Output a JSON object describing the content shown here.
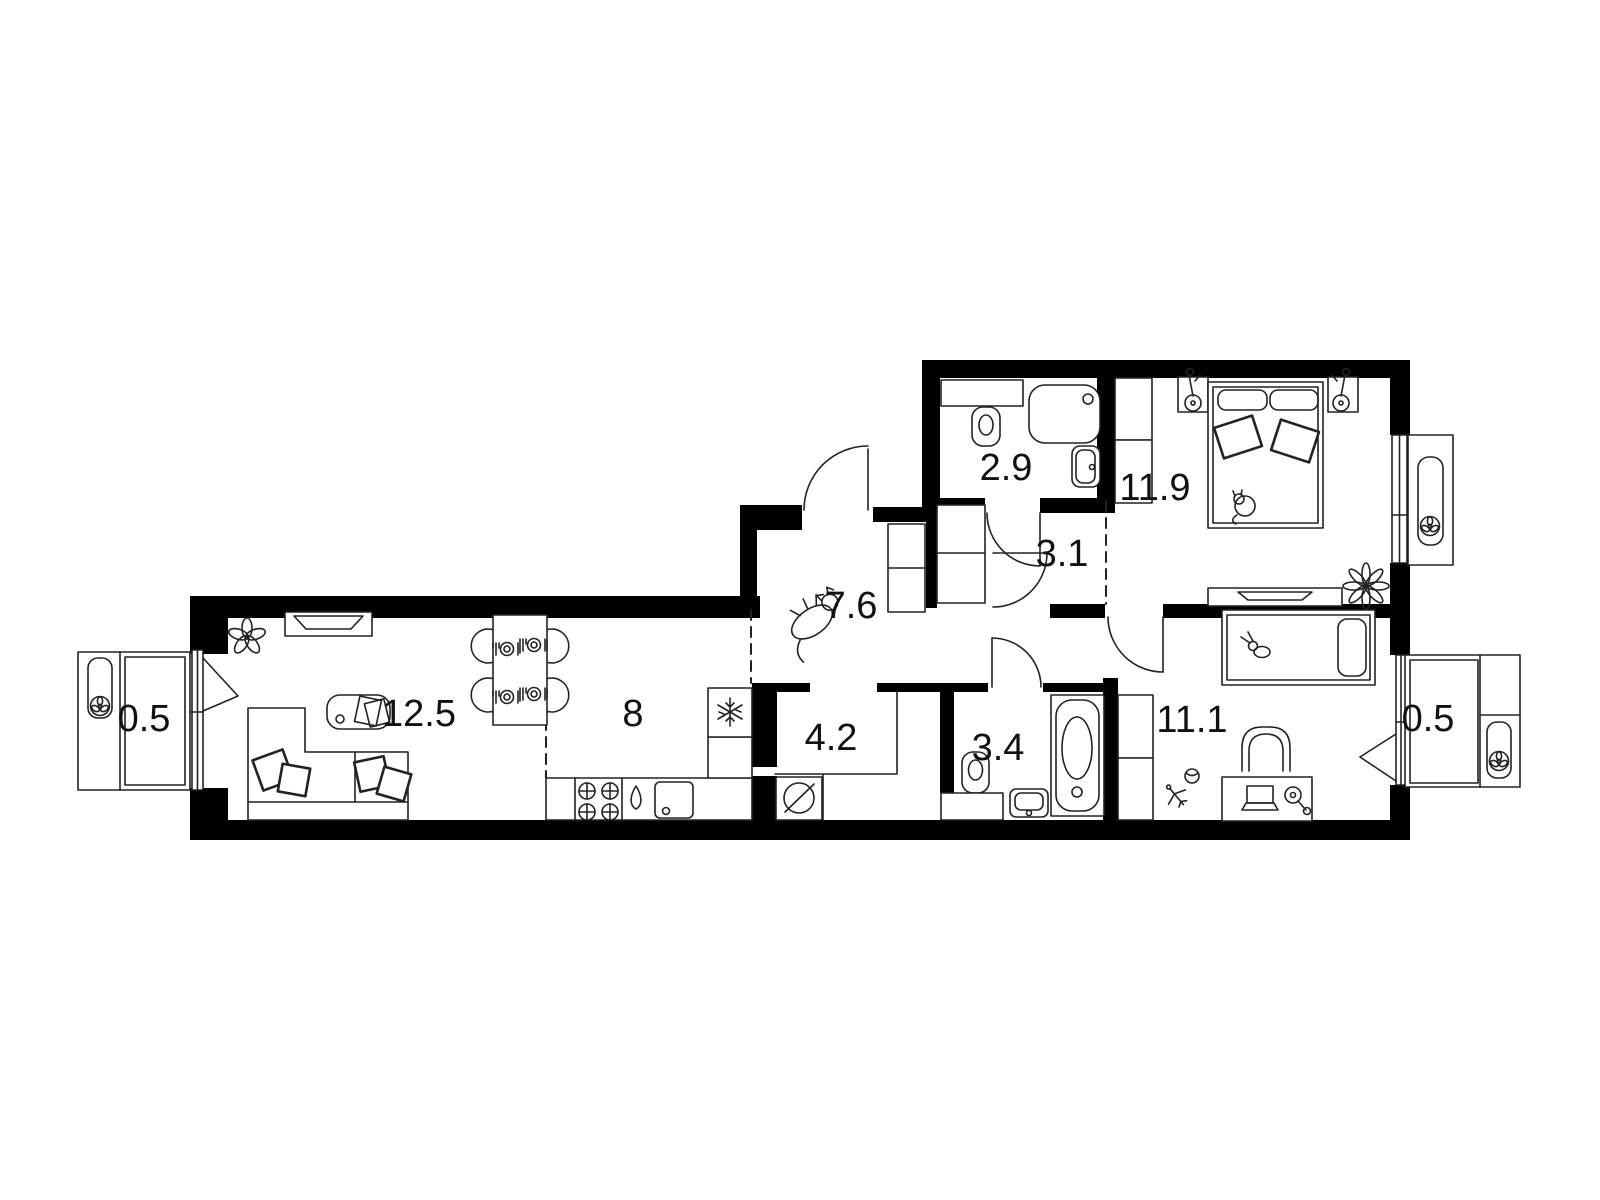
{
  "floorplan": {
    "rooms": [
      {
        "id": "balcony-left",
        "area": "0.5"
      },
      {
        "id": "living-room",
        "area": "12.5"
      },
      {
        "id": "kitchen",
        "area": "8"
      },
      {
        "id": "hallway",
        "area": "7.6"
      },
      {
        "id": "laundry",
        "area": "4.2"
      },
      {
        "id": "bathroom",
        "area": "3.4"
      },
      {
        "id": "toilet",
        "area": "2.9"
      },
      {
        "id": "corridor",
        "area": "3.1"
      },
      {
        "id": "bedroom",
        "area": "11.9"
      },
      {
        "id": "children-room",
        "area": "11.1"
      },
      {
        "id": "balcony-right",
        "area": "0.5"
      }
    ],
    "colors": {
      "wall": "#000000",
      "line": "#222222",
      "background": "#ffffff",
      "label": "#111111"
    }
  }
}
